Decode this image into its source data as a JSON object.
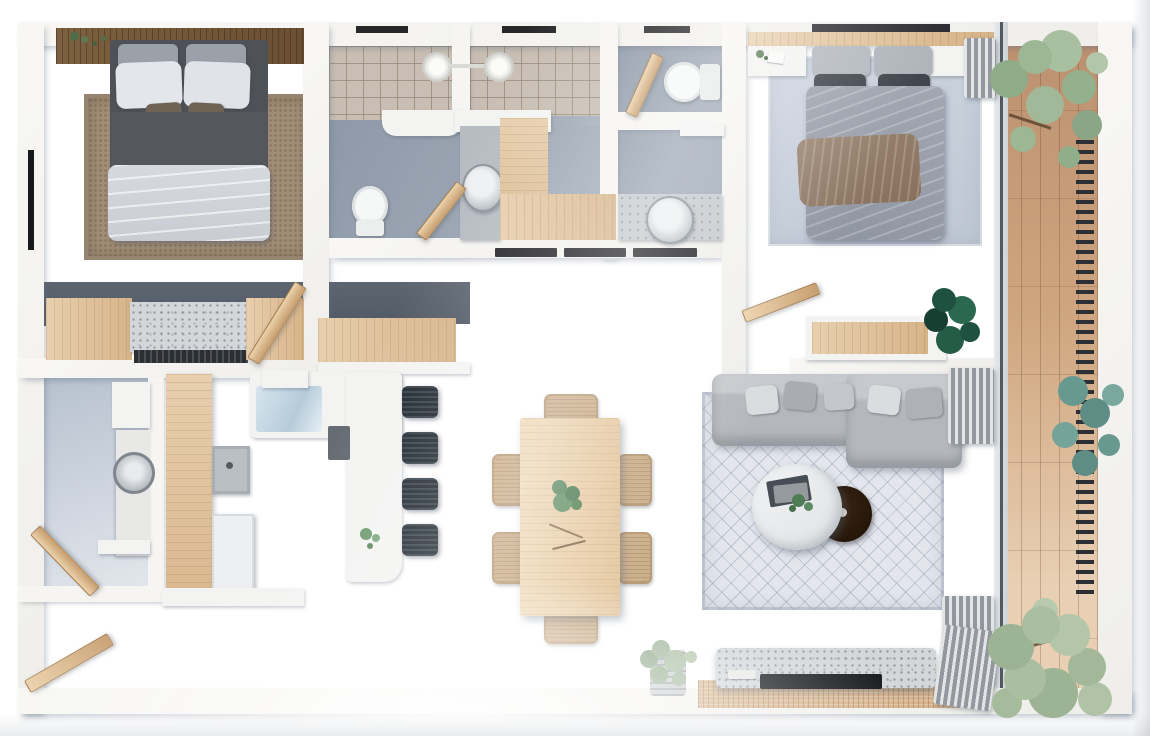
{
  "title": "Top-down 3D rendered apartment floor plan",
  "labels": {
    "master_bedroom": "Master bedroom",
    "closet": "Wardrobe and dresser row",
    "laundry": "Laundry room",
    "bathroom_main": "Main bathroom with double shower",
    "wc": "Second bathroom / WC",
    "second_bedroom": "Second bedroom",
    "kitchen": "Kitchen",
    "dining": "Dining area",
    "living": "Living room",
    "hallway": "Hallway",
    "balcony": "Balcony terrace with wood deck",
    "entry": "Entrance door"
  },
  "furniture": {
    "bed": "Double bed",
    "rug": "Area rug",
    "dresser": "Wood dresser",
    "washing_machine": "Washing machine",
    "island": "Kitchen island counter",
    "cooktop": "Cooktop",
    "bar_stool": "Bar stool",
    "dining_table": "Wood dining table",
    "dining_chair": "Rattan dining chair",
    "sofa": "L-shaped sofa",
    "coffee_table": "Round coffee table",
    "side_table": "Round dark side table",
    "tv_console": "Stone media console",
    "toilet": "Toilet",
    "sink": "Round basin sink",
    "shower": "Rain shower head",
    "plant": "Potted plant",
    "curtain": "Curtain",
    "door": "Wood door"
  },
  "counts": {
    "bedrooms": 2,
    "bathrooms": 2,
    "shower_heads": 2,
    "toilets": 2,
    "sinks": 3,
    "bar_stools": 4,
    "dining_chairs": 6,
    "balcony_plants": 3
  },
  "palette": {
    "wall": "#f5f4f1",
    "floor_blue_gray": "#a9b6ca",
    "accent_wall_dark": "#59616d",
    "wood_light": "#e2c6a3",
    "wood_dark": "#6f5538",
    "deck_wood": "#cfa67f",
    "sofa_gray": "#b6babf",
    "stool_black": "#20272e",
    "rug_brown": "#a18e78",
    "plant_sage": "#9fb69b",
    "plant_teal": "#68998f",
    "plant_dark_green": "#1f5140",
    "tile_beige": "#c8beb3",
    "terrazzo": "#d3d7da"
  }
}
